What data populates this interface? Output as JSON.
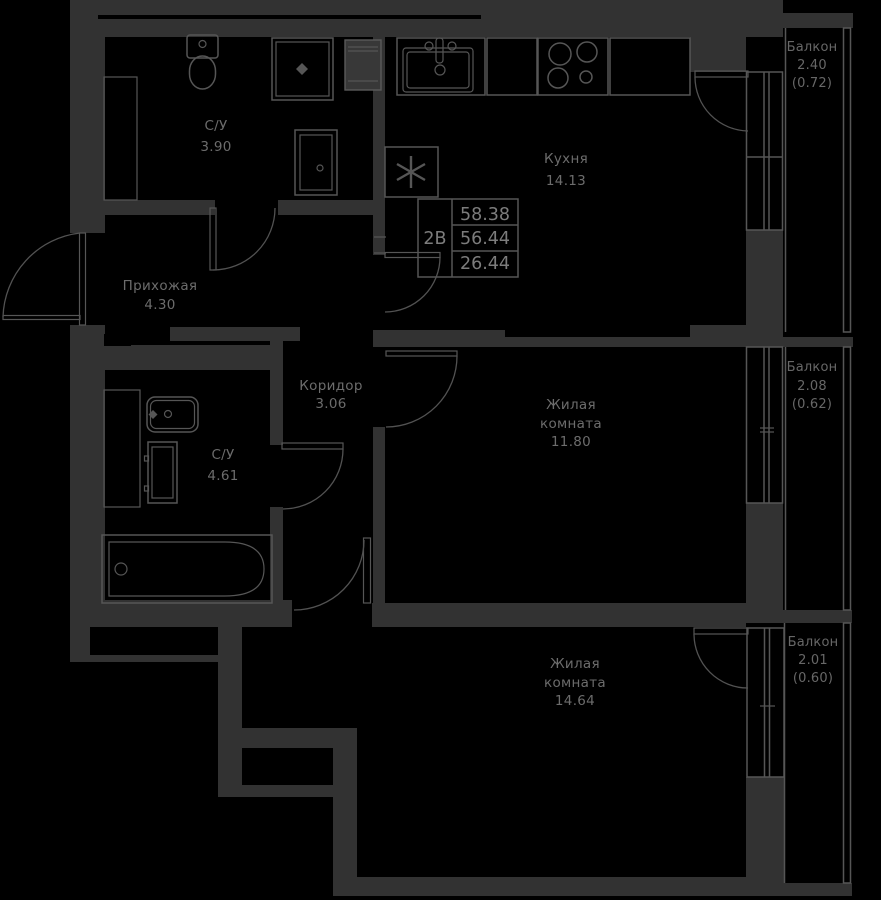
{
  "plan": {
    "info_box": {
      "unit": "2В",
      "total_area": "58.38",
      "area_2": "56.44",
      "living_area": "26.44"
    },
    "rooms": {
      "su1": {
        "name": "С/У",
        "area": "3.90"
      },
      "kitchen": {
        "name": "Кухня",
        "area": "14.13"
      },
      "hallway": {
        "name": "Прихожая",
        "area": "4.30"
      },
      "corridor": {
        "name": "Коридор",
        "area": "3.06"
      },
      "su2": {
        "name": "С/У",
        "area": "4.61"
      },
      "living1": {
        "line1": "Жилая",
        "line2": "комната",
        "area": "11.80"
      },
      "living2": {
        "line1": "Жилая",
        "line2": "комната",
        "area": "14.64"
      }
    },
    "balconies": {
      "b1": {
        "name": "Балкон",
        "area": "2.40",
        "coef": "(0.72)"
      },
      "b2": {
        "name": "Балкон",
        "area": "2.08",
        "coef": "(0.62)"
      },
      "b3": {
        "name": "Балкон",
        "area": "2.01",
        "coef": "(0.60)"
      }
    },
    "colors": {
      "background": "#000000",
      "wall": "#323232",
      "line": "#565656",
      "text": "#6c6c6c"
    }
  }
}
